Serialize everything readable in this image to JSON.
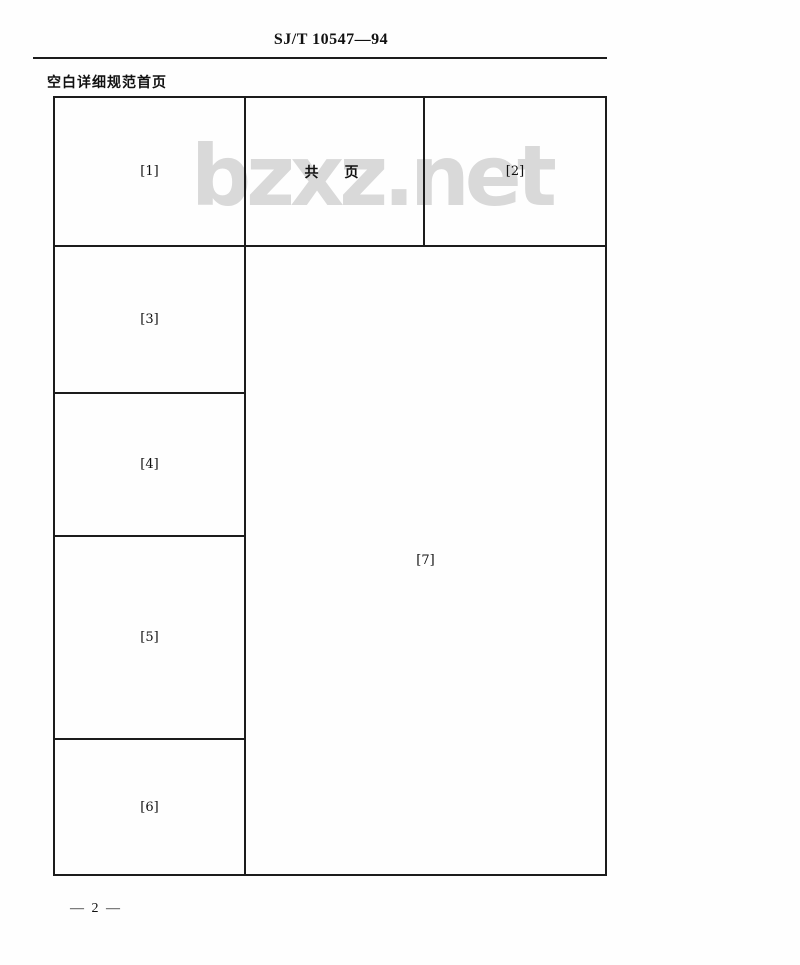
{
  "page": {
    "standard_number": "SJ/T 10547—94",
    "title": "空白详细规范首页",
    "page_number": "— 2 —",
    "watermark": "bzxz.net"
  },
  "form": {
    "cells": {
      "c1": "[1]",
      "pages": "共　页",
      "c2": "[2]",
      "c3": "[3]",
      "c4": "[4]",
      "c5": "[5]",
      "c6": "[6]",
      "c7": "[7]"
    }
  },
  "colors": {
    "line": "#1c1c1c",
    "text": "#111111",
    "watermark": "#d9d9d9",
    "background": "#fefefe"
  }
}
